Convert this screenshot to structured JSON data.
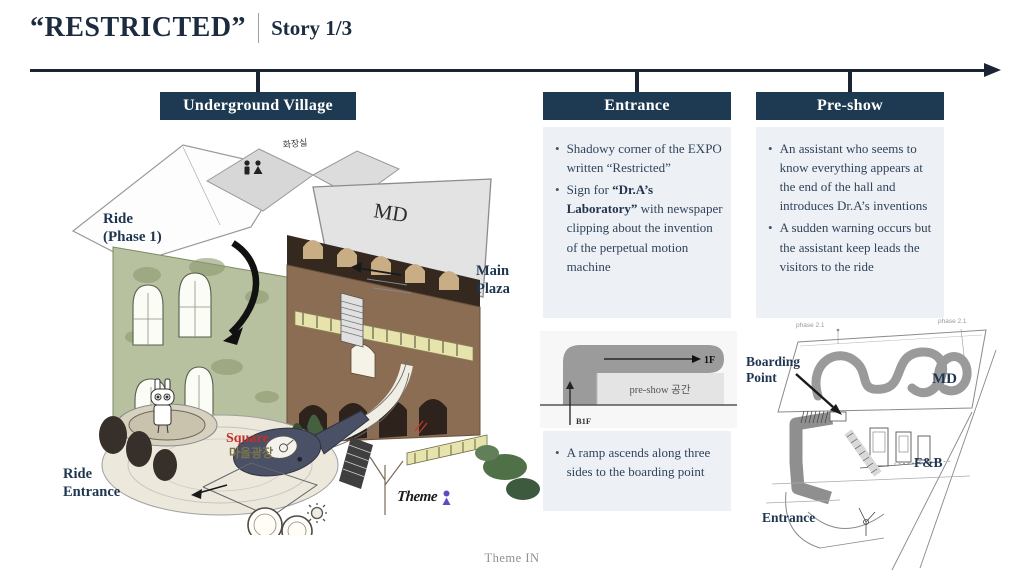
{
  "slide": {
    "title": "“RESTRICTED”",
    "subtitle": "Story 1/3",
    "footer": "Theme IN"
  },
  "headers": {
    "village": "Underground Village",
    "entrance": "Entrance",
    "preshow": "Pre-show"
  },
  "entrance_panel": {
    "bullet1": "Shadowy corner of the EXPO written “Restricted”",
    "bullet2_pre": "Sign for ",
    "bullet2_bold": "“Dr.A’s Laboratory”",
    "bullet2_post": " with newspaper clipping about the invention of the perpetual motion machine"
  },
  "preshow_panel": {
    "bullet1": "An assistant who seems to know everything appears at the end of the hall and introduces Dr.A’s inventions",
    "bullet2": "A sudden warning occurs but the assistant keep leads the visitors to the ride"
  },
  "ramp_panel": {
    "bullet1": "A ramp ascends along three sides to the boarding point"
  },
  "ramp_diagram": {
    "floor_upper": "1F",
    "floor_lower": "B1F",
    "area": "pre-show 공간"
  },
  "plan": {
    "boarding_line1": "Boarding",
    "boarding_line2": "Point",
    "md": "MD",
    "fnb": "F&B",
    "entrance": "Entrance",
    "phase_left": "phase 2.1",
    "phase_right": "phase 2.1"
  },
  "village_labels": {
    "ride_line1": "Ride",
    "ride_line2": "(Phase 1)",
    "main_plaza_line1": "Main",
    "main_plaza_line2": "Plaza",
    "ride_entrance_line1": "Ride",
    "ride_entrance_line2": "Entrance",
    "square_en": "Square",
    "square_kr": "마을광장",
    "restroom_kr": "화장실",
    "md_roof": "MD",
    "logo_text": "Theme"
  },
  "colors": {
    "navy": "#1e3a52",
    "timeline": "#1a2433",
    "panel_bg": "#edf1f6",
    "text": "#31435a",
    "red_accent": "#c2302a",
    "logo_purple": "#5b4cc0"
  }
}
